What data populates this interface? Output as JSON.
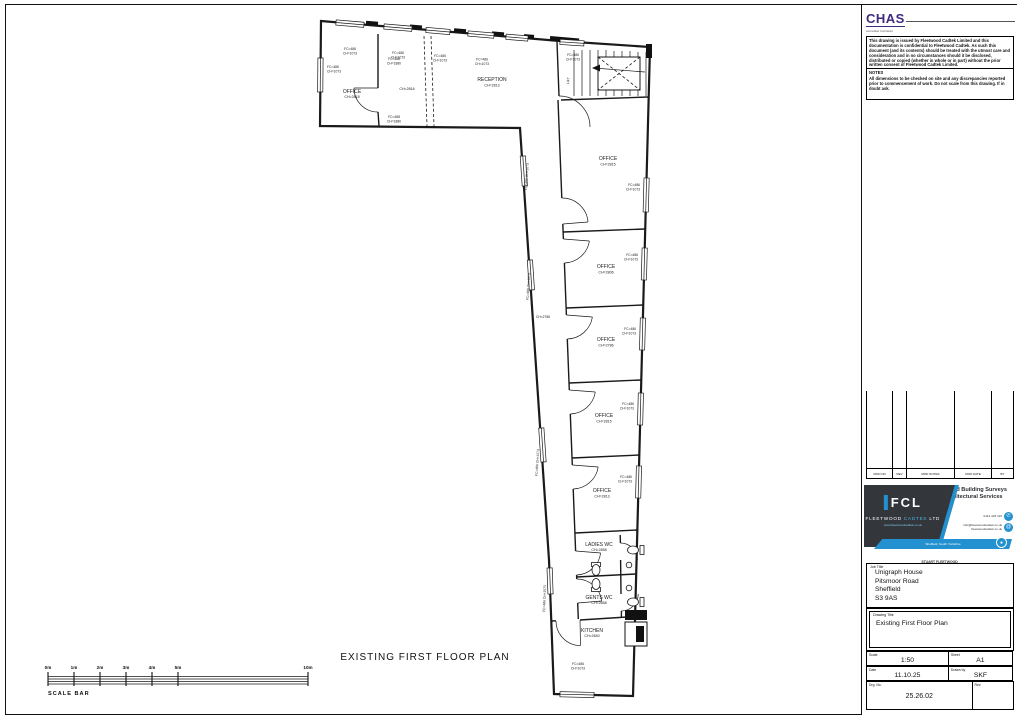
{
  "sheet": {
    "plan_title": "EXISTING FIRST FLOOR PLAN",
    "scale_bar": {
      "caption": "SCALE BAR",
      "ticks": [
        "0m",
        "1m",
        "2m",
        "3m",
        "4m",
        "5m",
        "10m"
      ]
    }
  },
  "plan": {
    "window_label": {
      "l1": "FC=486",
      "l2": "CH=1073"
    },
    "door_label": {
      "l1": "FC=488",
      "l2": "CH=1880"
    },
    "lift_label": "LIFT",
    "corridor": {
      "ch": "CH=2786",
      "win": "FC=486 CH=1073"
    },
    "rooms": {
      "office_tl": {
        "name": "OFFICE",
        "ch": "CH=2818"
      },
      "mid": {
        "ch": "CH=2816"
      },
      "reception": {
        "name": "RECEPTION",
        "ch": "CH=2813"
      },
      "office_a": {
        "name": "OFFICE",
        "ch": "CH=2815"
      },
      "office_b": {
        "name": "OFFICE",
        "ch": "CH=2806"
      },
      "office_c": {
        "name": "OFFICE",
        "ch": "CH=2786"
      },
      "office_d": {
        "name": "OFFICE",
        "ch": "CH=2815"
      },
      "office_e": {
        "name": "OFFICE",
        "ch": "CH=2813"
      },
      "ladies": {
        "name": "LADIES WC",
        "ch": "CH=2858"
      },
      "gents": {
        "name": "GENTS WC",
        "ch": "CH=2858"
      },
      "kitchen": {
        "name": "KITCHEN",
        "ch": "CH=2840"
      }
    }
  },
  "titleblock": {
    "chas": {
      "name": "CHAS",
      "sub": "Accredited Contractor"
    },
    "disclaimer": "This drawing is issued by Fleetwood Cadtek Limited and this documentation is confidential to Fleetwood Cadtek. As such this document (and its contents) should be treated with the utmost care and consideration and in no circumstances should it be disclosed, distributed or copied (whether in whole or in part) without the prior written consent of Fleetwood Cadtek Limited.",
    "notes_title": "NOTES",
    "notes": "All dimensions to be checked on site and any discrepancies reported prior to commencement of work. Do not scale from this drawing. If in doubt ask.",
    "revision": {
      "headers": [
        "MOD NO",
        "REV",
        "MOD NOTES",
        "MOD DATE",
        "BY"
      ]
    },
    "company": {
      "services_1": "Measured Building Surveys",
      "services_2": "& Architectural Services",
      "logo": "FCL",
      "name_1": "FLEETWOOD",
      "name_2": "CADTEK",
      "name_3": "LTD",
      "website": "www.fleetwoodcadtek.co.uk",
      "phone": "0114 418 110",
      "email_1": "info@fleetwoodcadtek.co.uk",
      "email_2": "fleetwoodcadtek.co.uk",
      "address": "Sheffield, South Yorkshire",
      "signature": "STUART FLEETWOOD",
      "phone_icon": "✆",
      "email_icon": "@",
      "pin_icon": "●"
    },
    "job": {
      "label": "Job Title",
      "lines": [
        "Unigraph House",
        "Pitsmoor Road",
        "Sheffield",
        "S3 9AS"
      ]
    },
    "drawing": {
      "label": "Drawing Title",
      "title": "Existing First Floor Plan"
    },
    "scale": {
      "label": "Scale",
      "value": "1:50"
    },
    "sheet_size": {
      "label": "Sheet",
      "value": "A1"
    },
    "date": {
      "label": "Date",
      "value": "11.10.25"
    },
    "drawn": {
      "label": "Drawn by",
      "value": "SKF"
    },
    "drg": {
      "label": "Drg. No.",
      "value": "25.26.02"
    },
    "rev": {
      "label": "Rev."
    }
  },
  "colors": {
    "accent_blue": "#2391cf",
    "logo_dark": "#33373c",
    "chas_purple": "#3f2a7e"
  }
}
